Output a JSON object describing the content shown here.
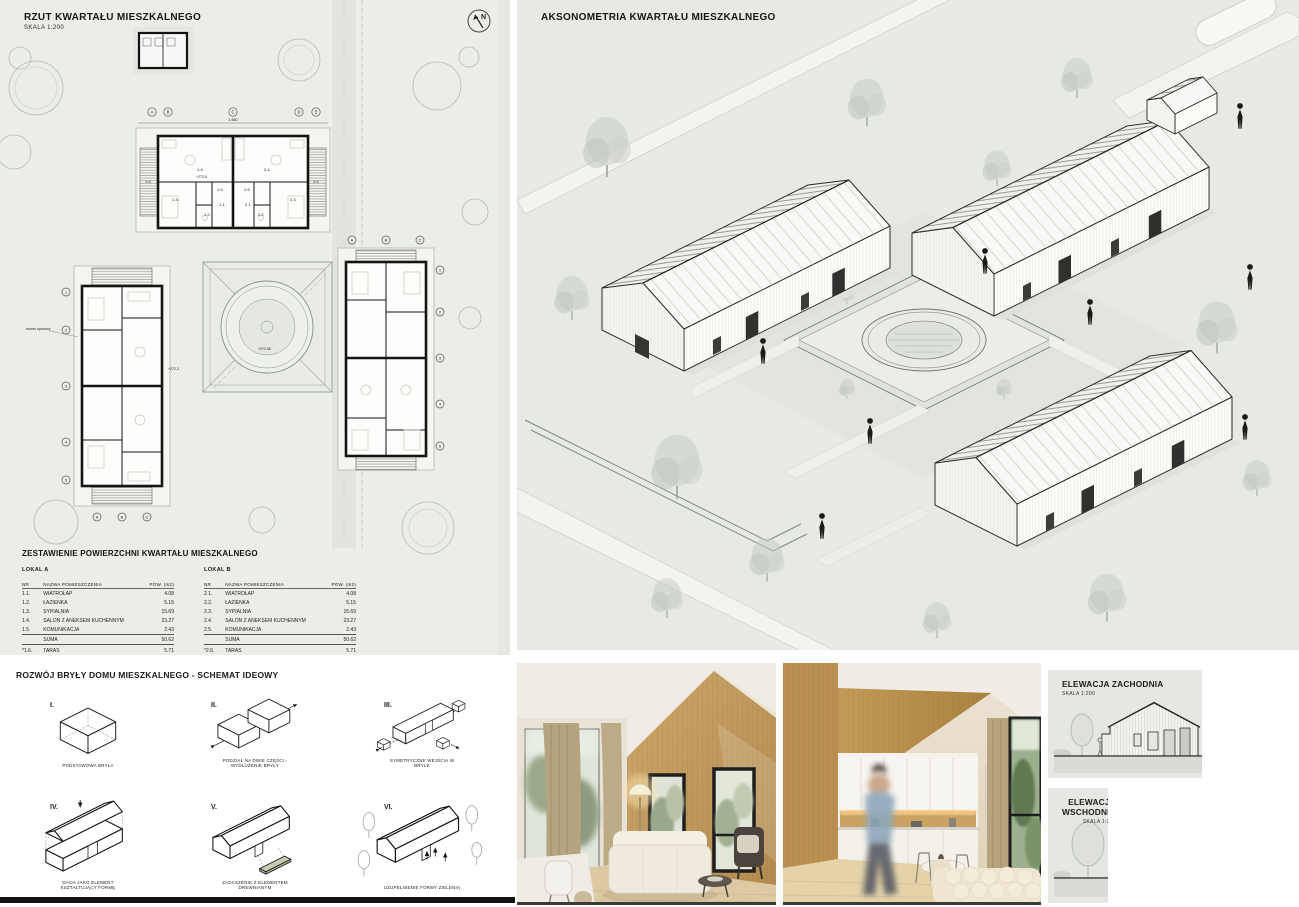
{
  "page": {
    "bg": "#ffffff",
    "edge_bar_color": "#111111"
  },
  "site_plan": {
    "title": "RZUT KWARTAŁU MIESZKALNEGO",
    "scale": "SKALA 1:200",
    "north_label": "N",
    "grid_letters": [
      "A",
      "B",
      "C",
      "D",
      "E"
    ],
    "grid_letters_side": [
      "A",
      "B",
      "C"
    ],
    "grid_numbers": [
      "1",
      "2",
      "3",
      "4",
      "5"
    ],
    "room_labels": [
      "1.1.",
      "1.2.",
      "1.3.",
      "1.4.",
      "1.5.",
      "1.6.",
      "2.1.",
      "2.2.",
      "2.3.",
      "2.4.",
      "2.5.",
      "2.6."
    ],
    "labels": {
      "retaining_wall": "murek oporowy",
      "spot_elev_1": "+272,6",
      "spot_elev_2": "+272,55",
      "spot_elev_3": "+272,3",
      "total_dim": "1 660"
    }
  },
  "area_table": {
    "title": "ZESTAWIENIE POWIERZCHNI KWARTAŁU MIESZKALNEGO",
    "columns": [
      "NR",
      "NAZWA POMIESZCZENIA",
      "POW. (m2)"
    ],
    "suma_label": "SUMA",
    "locals": [
      {
        "name": "LOKAL A",
        "rows": [
          [
            "1.1.",
            "WIATROŁAP",
            "4.08"
          ],
          [
            "1.2.",
            "ŁAZIENKA",
            "5.15"
          ],
          [
            "1.3.",
            "SYPIALNIA",
            "15.69"
          ],
          [
            "1.4.",
            "SALON Z ANEKSEM KUCHENNYM",
            "23.27"
          ],
          [
            "1.5.",
            "KOMUNIKACJA",
            "2.43"
          ]
        ],
        "suma": "50.62",
        "footnote": [
          "*1.6.",
          "TARAS",
          "5.71"
        ]
      },
      {
        "name": "LOKAL B",
        "rows": [
          [
            "2.1.",
            "WIATROŁAP",
            "4.08"
          ],
          [
            "2.2.",
            "ŁAZIENKA",
            "5.15"
          ],
          [
            "2.3.",
            "SYPIALNIA",
            "15.69"
          ],
          [
            "2.4.",
            "SALON Z ANEKSEM KUCHENNYM",
            "23.27"
          ],
          [
            "2.5.",
            "KOMUNIKACJA",
            "2.43"
          ]
        ],
        "suma": "50.62",
        "footnote": [
          "*2.6.",
          "TARAS",
          "5.71"
        ]
      }
    ]
  },
  "axonometry": {
    "title": "AKSONOMETRIA KWARTAŁU MIESZKALNEGO"
  },
  "massing": {
    "title": "ROZWÓJ BRYŁY DOMU MIESZKALNEGO - SCHEMAT IDEOWY",
    "steps": [
      {
        "numeral": "I.",
        "caption": "PODSTAWOWA BRYŁA"
      },
      {
        "numeral": "II.",
        "caption": "PODZIAŁ NA DWIE CZĘŚCI - WYDŁUŻENIE BRYŁY"
      },
      {
        "numeral": "III.",
        "caption": "SYMETRYCZNE WEJŚCIA W BRYLE"
      },
      {
        "numeral": "IV.",
        "caption": "DACH JAKO ELEMENT KSZTAŁTUJĄCY FORMĘ"
      },
      {
        "numeral": "V.",
        "caption": "ZADASZENIE Z ELEMENTEM DREWNIANYM"
      },
      {
        "numeral": "VI.",
        "caption": "UZUPEŁNIENIE FORMY ZIELENIĄ"
      }
    ]
  },
  "elevations": [
    {
      "title": "ELEWACJA ZACHODNIA",
      "scale": "SKALA 1:200",
      "levels": [
        "+5,34",
        "+3,20",
        "0,00"
      ]
    },
    {
      "title": "ELEWACJA WSCHODNIA",
      "scale": "SKALA 1:200",
      "levels": [
        "+5,34",
        "+3,20",
        "0,00"
      ]
    }
  ],
  "photos": [
    {
      "name": "interior-living-room"
    },
    {
      "name": "interior-kitchen-living"
    }
  ]
}
